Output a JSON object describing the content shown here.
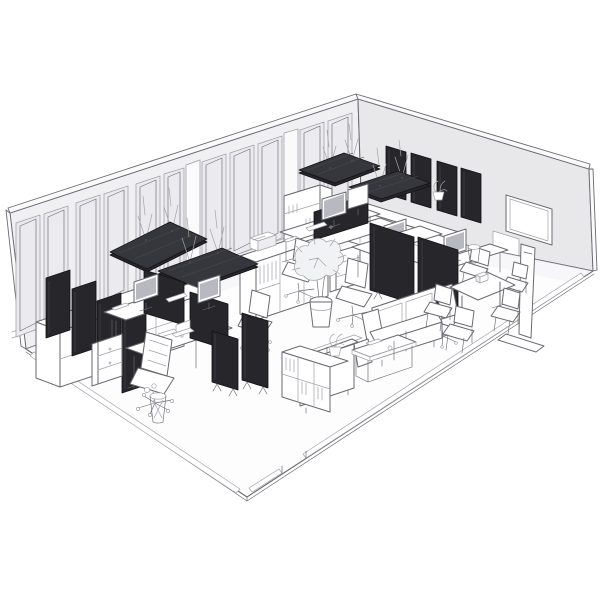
{
  "scene": {
    "type": "isometric-line-illustration",
    "subject": "Open-plan office interior rendering with dark acoustic panels, workstations, lounge and meeting area",
    "style": "grayscale 3D line art on white background"
  },
  "palette": {
    "bg": "#ffffff",
    "line": "#6a6a71",
    "line_soft": "#a3a3aa",
    "wall_left": "#f0f0f3",
    "panel_inset": "#ebebef",
    "wall_right": "#e8e8eb",
    "wall_cap": "#fafafb",
    "floor": "#fdfdfe",
    "floor_edge": "#f2f2f5",
    "acoustic": "#26262b",
    "acoustic_top": "#36363d",
    "acoustic_rim": "#121216",
    "acoustic_hi": "#4a4a52",
    "white_f": "#ffffff",
    "furniture_shade": "#ededf0",
    "screen_gray": "#b8b8c0",
    "foliage": "#f1f2f4"
  },
  "inventory": {
    "ceiling_acoustic_panels": 4,
    "wall_acoustic_panels_right_wall": 4,
    "leaning_acoustic_panels_left_wall": 4,
    "freestanding_acoustic_screens": 4,
    "desk_privacy_screens": 3,
    "desks": 6,
    "monitors": 6,
    "task_chairs": 5,
    "meeting_chairs": 5,
    "meeting_tables": 1,
    "sofas": 2,
    "coffee_tables": 1,
    "display_on_stand": 1,
    "storage_units": 5,
    "plants": 3,
    "waste_bins": 2
  }
}
